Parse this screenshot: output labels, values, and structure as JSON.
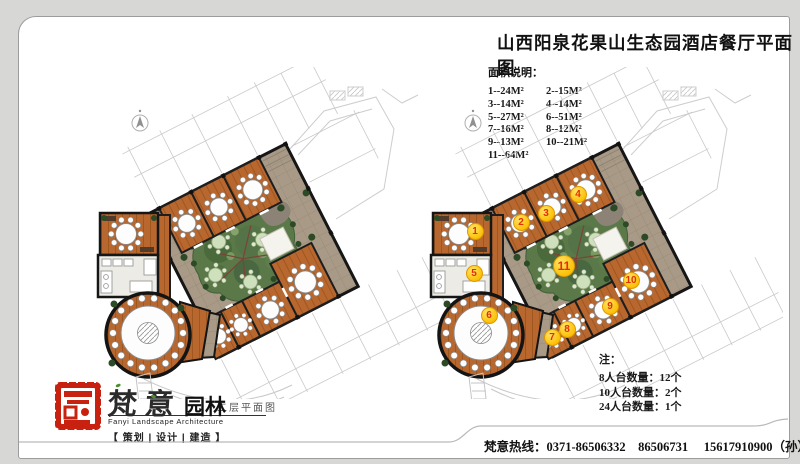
{
  "page": {
    "title": "山西阳泉花果山生态园酒店餐厅平面图"
  },
  "legend": {
    "title": "面积说明：",
    "entries": [
      "1--24M²",
      "2--15M²",
      "3--14M²",
      "4--14M²",
      "5--27M²",
      "6--51M²",
      "7--16M²",
      "8--12M²",
      "9--13M²",
      "10--21M²",
      "11--64M²"
    ]
  },
  "plans": {
    "left_label": "二层平面图"
  },
  "markers": [
    {
      "n": "1",
      "x": 58,
      "y": 164
    },
    {
      "n": "2",
      "x": 104,
      "y": 155
    },
    {
      "n": "3",
      "x": 129,
      "y": 146
    },
    {
      "n": "4",
      "x": 161,
      "y": 127
    },
    {
      "n": "5",
      "x": 57,
      "y": 206
    },
    {
      "n": "6",
      "x": 72,
      "y": 248
    },
    {
      "n": "7",
      "x": 135,
      "y": 270
    },
    {
      "n": "8",
      "x": 150,
      "y": 262
    },
    {
      "n": "9",
      "x": 193,
      "y": 239
    },
    {
      "n": "10",
      "x": 214,
      "y": 213
    },
    {
      "n": "11",
      "x": 147,
      "y": 199
    }
  ],
  "notes": {
    "title": "注：",
    "items": [
      "8人台数量：12个",
      "10人台数量：2个",
      "24人台数量：1个"
    ]
  },
  "brand": {
    "seal_char": "意",
    "name_zh": "梵意",
    "name_suffix": "园林",
    "name_en": "Fanyi Landscape Architecture",
    "services": [
      "策划",
      "设计",
      "建造"
    ],
    "bracket_open": "【",
    "bracket_close": "】",
    "separator": "|"
  },
  "footer": {
    "hotline": "梵意热线：0371-86506332　86506731　 15617910900（孙）"
  },
  "colors": {
    "wood": "#b8672f",
    "stone": "#a89a87",
    "garden": "#5a7848",
    "accent_red": "#c8210f",
    "marker_fill": "#fcbf00",
    "marker_text": "#e33000"
  }
}
